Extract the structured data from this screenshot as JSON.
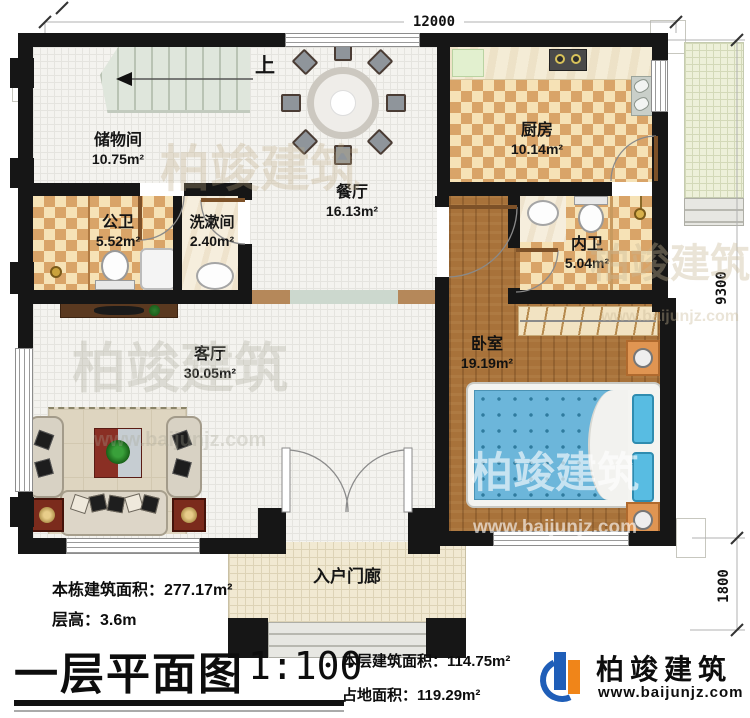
{
  "dimensions": {
    "width": "12000",
    "height_main": "9300",
    "height_porch": "1800"
  },
  "stairs": {
    "up_label": "上"
  },
  "rooms": {
    "storage": {
      "name": "储物间",
      "area": "10.75m²"
    },
    "dining": {
      "name": "餐厅",
      "area": "16.13m²"
    },
    "kitchen": {
      "name": "厨房",
      "area": "10.14m²"
    },
    "public_bath": {
      "name": "公卫",
      "area": "5.52m²"
    },
    "washroom": {
      "name": "洗漱间",
      "area": "2.40m²"
    },
    "inner_bath": {
      "name": "内卫",
      "area": "5.04m²"
    },
    "bedroom": {
      "name": "卧室",
      "area": "19.19m²"
    },
    "living": {
      "name": "客厅",
      "area": "30.05m²"
    },
    "porch": {
      "name": "入户门廊"
    }
  },
  "info": {
    "building_area": "本栋建筑面积：277.17m²",
    "floor_height": "层高：3.6m",
    "title": "一层平面图",
    "scale": "1:100",
    "floor_area": "本层建筑面积：114.75m²",
    "footprint": "占地面积：119.29m²"
  },
  "brand": {
    "name": "柏竣建筑",
    "website": "www.baijunjz.com"
  },
  "watermark": {
    "name": "柏竣建筑",
    "website": "www.baijunjz.com"
  },
  "colors": {
    "wall": "#161616",
    "checker": "#d9a468",
    "wood": "#a8723a",
    "accent_blue": "#1f5eb8",
    "accent_orange": "#f08519"
  }
}
